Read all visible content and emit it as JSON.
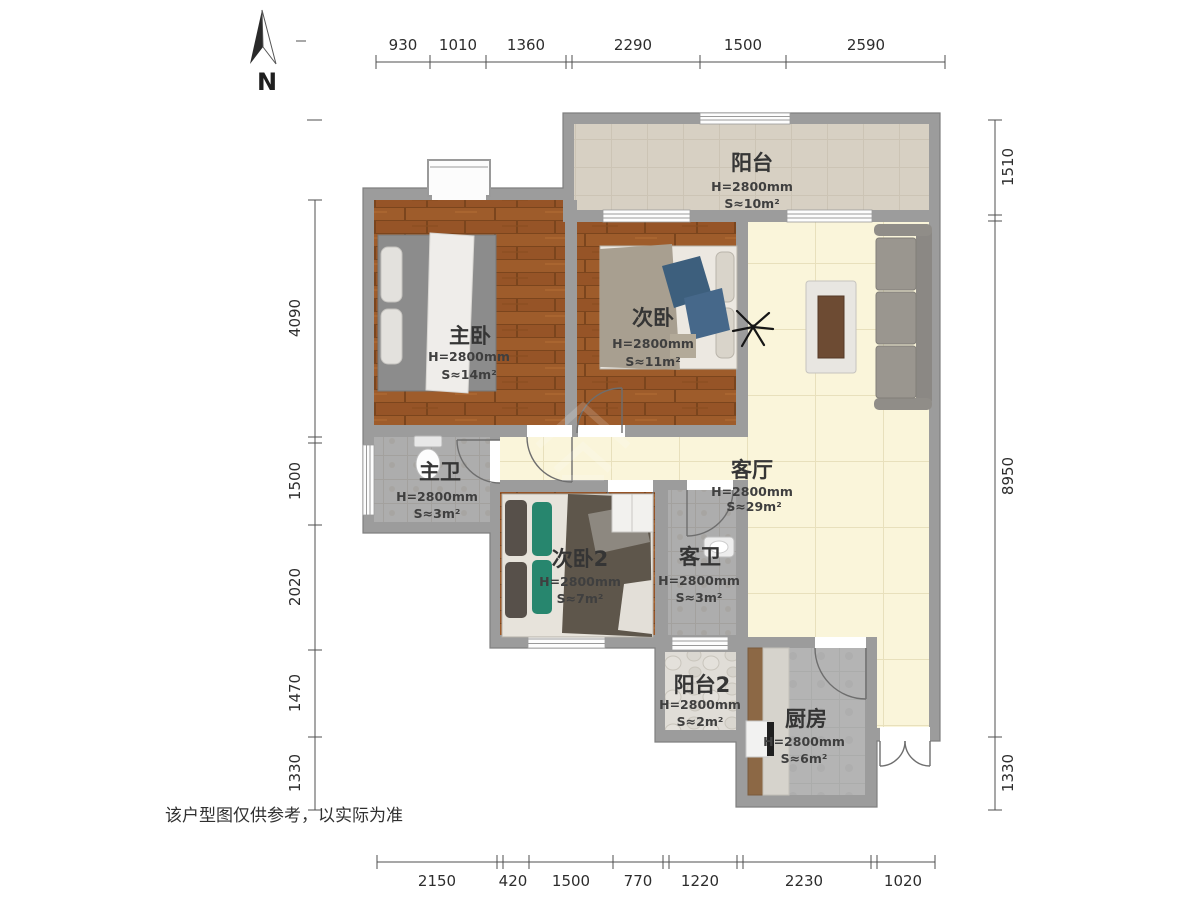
{
  "page": {
    "background": "#ffffff",
    "disclaimer": "该户型图仅供参考，以实际为准"
  },
  "compass": {
    "label": "N"
  },
  "rooms": {
    "balcony": {
      "name": "阳台",
      "height": "H=2800mm",
      "area": "S≈10m²"
    },
    "master_bedroom": {
      "name": "主卧",
      "height": "H=2800mm",
      "area": "S≈14m²"
    },
    "bedroom2": {
      "name": "次卧",
      "height": "H=2800mm",
      "area": "S≈11m²"
    },
    "living_room": {
      "name": "客厅",
      "height": "H=2800mm",
      "area": "S≈29m²"
    },
    "master_bath": {
      "name": "主卫",
      "height": "H=2800mm",
      "area": "S≈3m²"
    },
    "bedroom3": {
      "name": "次卧2",
      "height": "H=2800mm",
      "area": "S≈7m²"
    },
    "guest_bath": {
      "name": "客卫",
      "height": "H=2800mm",
      "area": "S≈3m²"
    },
    "balcony2": {
      "name": "阳台2",
      "height": "H=2800mm",
      "area": "S≈2m²"
    },
    "kitchen": {
      "name": "厨房",
      "height": "H=2800mm",
      "area": "S≈6m²"
    }
  },
  "dimensions": {
    "top": [
      "930",
      "1010",
      "1360",
      "2290",
      "1500",
      "2590"
    ],
    "left": [
      "4090",
      "1500",
      "2020",
      "1470",
      "1330"
    ],
    "right": [
      "1510",
      "8950",
      "1330"
    ],
    "bottom": [
      "2150",
      "420",
      "1500",
      "770",
      "1220",
      "2230",
      "1020"
    ]
  },
  "colors": {
    "wall": "#9c9c9c",
    "perimeter": "#7f7f7f",
    "wood_floor": "#9c5a2a",
    "tile_floor": "#faf5da",
    "bath_floor": "#adadad",
    "balcony_floor": "#d7d0c3",
    "pebble_floor": "#e0ddd7",
    "kitchen_floor": "#b4b4b4",
    "label_text": "#353535",
    "dimension_text": "#2d2d2d"
  }
}
